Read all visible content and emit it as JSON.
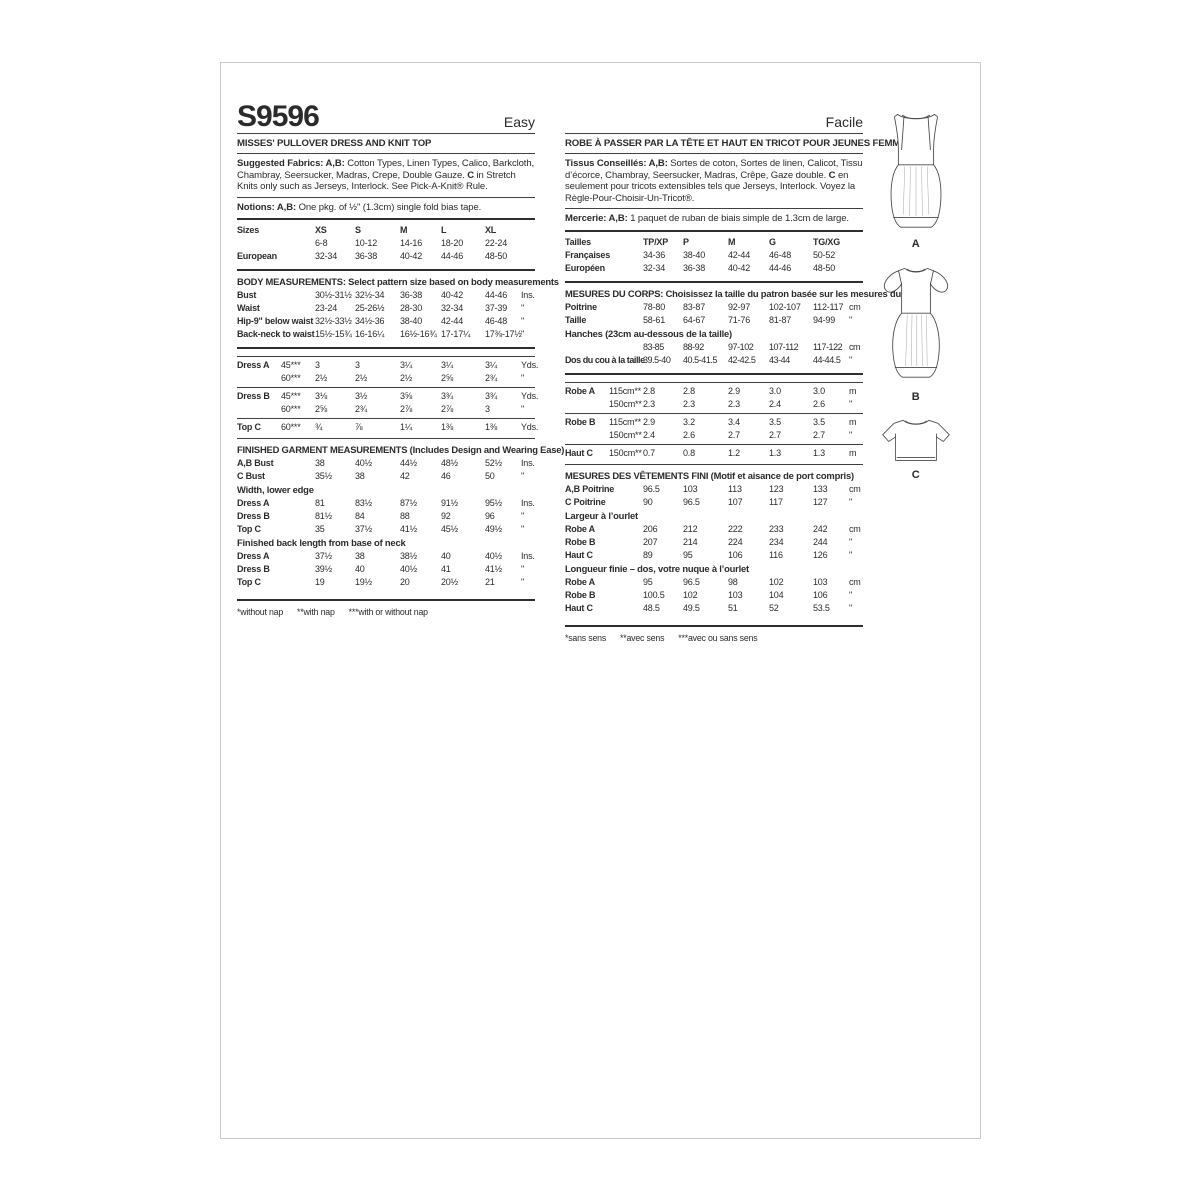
{
  "en": {
    "number": "S9596",
    "difficulty": "Easy",
    "title": "MISSES' PULLOVER DRESS AND KNIT TOP",
    "fabrics": {
      "lead": "Suggested Fabrics: A,B:",
      "mid": " Cotton Types, Linen Types, Calico, Barkcloth, Chambray, Seersucker, Madras, Crepe, Double Gauze. ",
      "c": "C",
      "tail": " in Stretch Knits only such as Jerseys, Interlock. See Pick-A-Knit® Rule."
    },
    "notions": {
      "lead": "Notions: A,B:",
      "tail": " One pkg. of ½\" (1.3cm) single fold bias tape."
    },
    "sizes": {
      "head": [
        "Sizes",
        "XS",
        "S",
        "M",
        "L",
        "XL"
      ],
      "rows": [
        [
          "",
          "6-8",
          "10-12",
          "14-16",
          "18-20",
          "22-24",
          ""
        ],
        [
          "European",
          "32-34",
          "36-38",
          "40-42",
          "44-46",
          "48-50",
          ""
        ]
      ]
    },
    "body": {
      "header": "BODY MEASUREMENTS: Select pattern size based on body measurements",
      "rows": [
        [
          "Bust",
          "30½-31½",
          "32½-34",
          "36-38",
          "40-42",
          "44-46",
          "Ins."
        ],
        [
          "Waist",
          "23-24",
          "25-26½",
          "28-30",
          "32-34",
          "37-39",
          "\""
        ],
        [
          "Hip-9\" below waist",
          "32½-33½",
          "34½-36",
          "38-40",
          "42-44",
          "46-48",
          "\""
        ],
        [
          "Back-neck to waist",
          "15½-15¾",
          "16-16¼",
          "16½-16¾",
          "17-17¼",
          "17⅜-17½",
          "\""
        ]
      ]
    },
    "yardage_a": {
      "rows": [
        [
          "Dress A",
          "45***",
          "3",
          "3",
          "3¼",
          "3¼",
          "3¼",
          "Yds."
        ],
        [
          "",
          "60***",
          "2½",
          "2½",
          "2½",
          "2⅝",
          "2¾",
          "\""
        ]
      ]
    },
    "yardage_b": {
      "rows": [
        [
          "Dress B",
          "45***",
          "3⅛",
          "3½",
          "3⅝",
          "3¾",
          "3¾",
          "Yds."
        ],
        [
          "",
          "60***",
          "2⅝",
          "2¾",
          "2⅞",
          "2⅞",
          "3",
          "\""
        ]
      ]
    },
    "yardage_c": {
      "rows": [
        [
          "Top C",
          "60***",
          "¾",
          "⅞",
          "1¼",
          "1⅜",
          "1⅜",
          "Yds."
        ]
      ]
    },
    "finished": {
      "header": "FINISHED GARMENT MEASUREMENTS (Includes Design and Wearing Ease)",
      "bust_rows": [
        [
          "A,B Bust",
          "38",
          "40½",
          "44½",
          "48½",
          "52½",
          "Ins."
        ],
        [
          "C Bust",
          "35½",
          "38",
          "42",
          "46",
          "50",
          "\""
        ]
      ],
      "width_header": "Width, lower edge",
      "width_rows": [
        [
          "Dress A",
          "81",
          "83½",
          "87½",
          "91½",
          "95½",
          "Ins."
        ],
        [
          "Dress B",
          "81½",
          "84",
          "88",
          "92",
          "96",
          "\""
        ],
        [
          "Top C",
          "35",
          "37½",
          "41½",
          "45½",
          "49½",
          "\""
        ]
      ],
      "length_header": "Finished back length from base of neck",
      "length_rows": [
        [
          "Dress A",
          "37½",
          "38",
          "38½",
          "40",
          "40½",
          "Ins."
        ],
        [
          "Dress B",
          "39½",
          "40",
          "40½",
          "41",
          "41½",
          "\""
        ],
        [
          "Top C",
          "19",
          "19½",
          "20",
          "20½",
          "21",
          "\""
        ]
      ]
    },
    "footnotes": [
      "*without nap",
      "**with nap",
      "***with or without nap"
    ]
  },
  "fr": {
    "difficulty": "Facile",
    "title": "ROBE À PASSER PAR LA TÊTE ET HAUT EN TRICOT POUR JEUNES FEMMES",
    "fabrics": {
      "lead": "Tissus Conseillés: A,B:",
      "mid": " Sortes de coton, Sortes de linen, Calicot, Tissu d’écorce, Chambray, Seersucker, Madras, Crêpe, Gaze double. ",
      "c": "C",
      "tail": " en seulement pour tricots extensibles tels que Jerseys, Interlock. Voyez la Règle-Pour-Choisir-Un-Tricot®."
    },
    "notions": {
      "lead": "Mercerie: A,B:",
      "tail": " 1 paquet de ruban de biais simple de 1.3cm de large."
    },
    "sizes": {
      "head": [
        "Tailles",
        "TP/XP",
        "P",
        "M",
        "G",
        "TG/XG"
      ],
      "rows": [
        [
          "Françaises",
          "34-36",
          "38-40",
          "42-44",
          "46-48",
          "50-52",
          ""
        ],
        [
          "Européen",
          "32-34",
          "36-38",
          "40-42",
          "44-46",
          "48-50",
          ""
        ]
      ]
    },
    "body": {
      "header": "MESURES DU CORPS: Choisissez la taille du patron basée sur les mesures du corps",
      "rows1": [
        [
          "Poitrine",
          "78-80",
          "83-87",
          "92-97",
          "102-107",
          "112-117",
          "cm"
        ],
        [
          "Taille",
          "58-61",
          "64-67",
          "71-76",
          "81-87",
          "94-99",
          "\""
        ]
      ],
      "hanches_header": "Hanches (23cm au-dessous de la taille)",
      "rows2": [
        [
          "",
          "83-85",
          "88-92",
          "97-102",
          "107-112",
          "117-122",
          "cm"
        ],
        [
          "Dos du cou à la taille",
          "39.5-40",
          "40.5-41.5",
          "42-42.5",
          "43-44",
          "44-44.5",
          "\""
        ]
      ]
    },
    "yardage_a": {
      "rows": [
        [
          "Robe A",
          "115cm**",
          "2.8",
          "2.8",
          "2.9",
          "3.0",
          "3.0",
          "m"
        ],
        [
          "",
          "150cm**",
          "2.3",
          "2.3",
          "2.3",
          "2.4",
          "2.6",
          "\""
        ]
      ]
    },
    "yardage_b": {
      "rows": [
        [
          "Robe B",
          "115cm**",
          "2.9",
          "3.2",
          "3.4",
          "3.5",
          "3.5",
          "m"
        ],
        [
          "",
          "150cm**",
          "2.4",
          "2.6",
          "2.7",
          "2.7",
          "2.7",
          "\""
        ]
      ]
    },
    "yardage_c": {
      "rows": [
        [
          "Haut C",
          "150cm**",
          "0.7",
          "0.8",
          "1.2",
          "1.3",
          "1.3",
          "m"
        ]
      ]
    },
    "finished": {
      "header": "MESURES DES VÊTEMENTS FINI (Motif et aisance de port compris)",
      "bust_rows": [
        [
          "A,B Poitrine",
          "96.5",
          "103",
          "113",
          "123",
          "133",
          "cm"
        ],
        [
          "C Poitrine",
          "90",
          "96.5",
          "107",
          "117",
          "127",
          "\""
        ]
      ],
      "width_header": "Largeur à l’ourlet",
      "width_rows": [
        [
          "Robe A",
          "206",
          "212",
          "222",
          "233",
          "242",
          "cm"
        ],
        [
          "Robe B",
          "207",
          "214",
          "224",
          "234",
          "244",
          "\""
        ],
        [
          "Haut C",
          "89",
          "95",
          "106",
          "116",
          "126",
          "\""
        ]
      ],
      "length_header": "Longueur finie – dos, votre nuque à l’ourlet",
      "length_rows": [
        [
          "Robe A",
          "95",
          "96.5",
          "98",
          "102",
          "103",
          "cm"
        ],
        [
          "Robe B",
          "100.5",
          "102",
          "103",
          "104",
          "106",
          "\""
        ],
        [
          "Haut C",
          "48.5",
          "49.5",
          "51",
          "52",
          "53.5",
          "\""
        ]
      ]
    },
    "footnotes": [
      "*sans sens",
      "**avec sens",
      "***avec ou sans sens"
    ]
  },
  "views": [
    {
      "label": "A"
    },
    {
      "label": "B"
    },
    {
      "label": "C"
    }
  ]
}
